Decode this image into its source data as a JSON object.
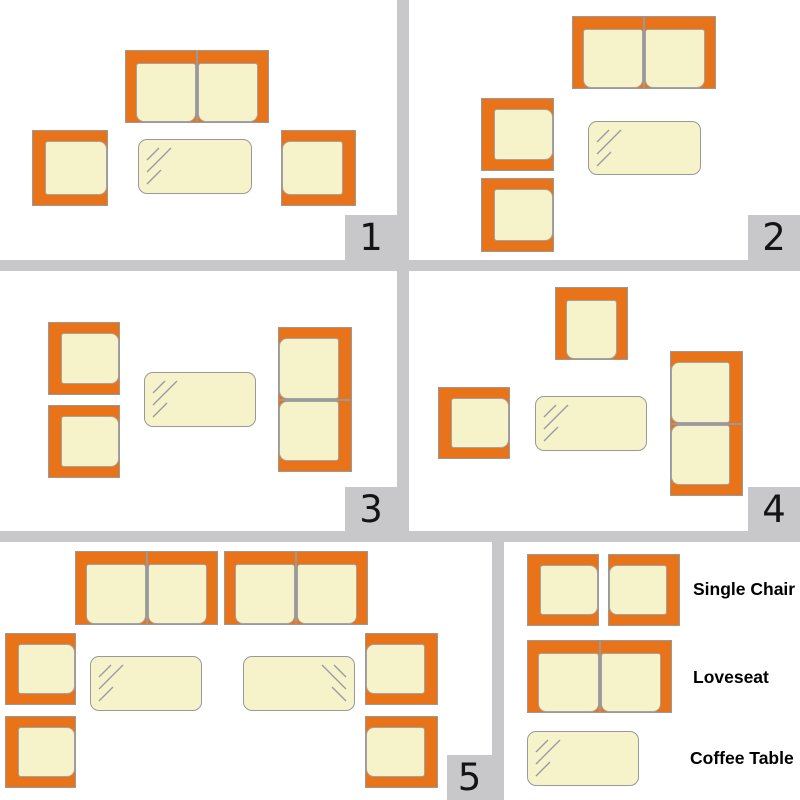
{
  "colors": {
    "frame_orange": "#E87318",
    "cushion_cream": "#F6F3CB",
    "outline_gray": "#999999",
    "divider_gray": "#C8C8CB",
    "number_black": "#141414"
  },
  "panels": [
    {
      "number": "1",
      "pieces": [
        {
          "item": "loveseat",
          "type": "loveseat",
          "x": 125,
          "y": 50,
          "w": 144,
          "h": 73,
          "open": "bottom"
        },
        {
          "item": "single-chair",
          "type": "chair",
          "x": 32,
          "y": 130,
          "w": 76,
          "h": 76,
          "open": "right"
        },
        {
          "item": "coffee-table",
          "type": "table",
          "x": 138,
          "y": 139,
          "w": 114,
          "h": 55,
          "glass": "tl"
        },
        {
          "item": "single-chair",
          "type": "chair",
          "x": 281,
          "y": 130,
          "w": 75,
          "h": 76,
          "open": "left"
        }
      ]
    },
    {
      "number": "2",
      "pieces": [
        {
          "item": "loveseat",
          "type": "loveseat",
          "x": 572,
          "y": 16,
          "w": 144,
          "h": 73,
          "open": "bottom"
        },
        {
          "item": "single-chair",
          "type": "chair",
          "x": 481,
          "y": 98,
          "w": 73,
          "h": 73,
          "open": "right"
        },
        {
          "item": "single-chair",
          "type": "chair",
          "x": 481,
          "y": 178,
          "w": 73,
          "h": 74,
          "open": "right"
        },
        {
          "item": "coffee-table",
          "type": "table",
          "x": 588,
          "y": 121,
          "w": 113,
          "h": 54,
          "glass": "tl"
        }
      ]
    },
    {
      "number": "3",
      "pieces": [
        {
          "item": "single-chair",
          "type": "chair",
          "x": 48,
          "y": 322,
          "w": 72,
          "h": 73,
          "open": "right"
        },
        {
          "item": "single-chair",
          "type": "chair",
          "x": 48,
          "y": 405,
          "w": 72,
          "h": 73,
          "open": "right"
        },
        {
          "item": "coffee-table",
          "type": "table",
          "x": 144,
          "y": 372,
          "w": 112,
          "h": 55,
          "glass": "tl"
        },
        {
          "item": "loveseat",
          "type": "loveseat",
          "x": 278,
          "y": 327,
          "w": 74,
          "h": 145,
          "open": "left"
        }
      ]
    },
    {
      "number": "4",
      "pieces": [
        {
          "item": "single-chair",
          "type": "chair",
          "x": 555,
          "y": 287,
          "w": 73,
          "h": 73,
          "open": "bottom"
        },
        {
          "item": "single-chair",
          "type": "chair",
          "x": 438,
          "y": 387,
          "w": 72,
          "h": 72,
          "open": "right"
        },
        {
          "item": "coffee-table",
          "type": "table",
          "x": 535,
          "y": 396,
          "w": 112,
          "h": 55,
          "glass": "tl"
        },
        {
          "item": "loveseat",
          "type": "loveseat",
          "x": 670,
          "y": 351,
          "w": 73,
          "h": 145,
          "open": "left"
        }
      ]
    },
    {
      "number": "5",
      "pieces": [
        {
          "item": "loveseat",
          "type": "loveseat",
          "x": 75,
          "y": 551,
          "w": 143,
          "h": 74,
          "open": "bottom"
        },
        {
          "item": "loveseat",
          "type": "loveseat",
          "x": 224,
          "y": 551,
          "w": 144,
          "h": 74,
          "open": "bottom"
        },
        {
          "item": "single-chair",
          "type": "chair",
          "x": 5,
          "y": 633,
          "w": 71,
          "h": 72,
          "open": "right"
        },
        {
          "item": "single-chair",
          "type": "chair",
          "x": 5,
          "y": 716,
          "w": 71,
          "h": 72,
          "open": "right"
        },
        {
          "item": "coffee-table",
          "type": "table",
          "x": 90,
          "y": 656,
          "w": 112,
          "h": 55,
          "glass": "tl"
        },
        {
          "item": "coffee-table",
          "type": "table",
          "x": 243,
          "y": 656,
          "w": 112,
          "h": 55,
          "glass": "tr"
        },
        {
          "item": "single-chair",
          "type": "chair",
          "x": 365,
          "y": 633,
          "w": 73,
          "h": 72,
          "open": "left"
        },
        {
          "item": "single-chair",
          "type": "chair",
          "x": 365,
          "y": 716,
          "w": 73,
          "h": 72,
          "open": "left"
        }
      ]
    }
  ],
  "legend": {
    "items": [
      {
        "label": "Single Chair",
        "shapes": [
          {
            "item": "single-chair",
            "type": "chair",
            "x": 527,
            "y": 554,
            "w": 72,
            "h": 72,
            "open": "right"
          },
          {
            "item": "single-chair",
            "type": "chair",
            "x": 608,
            "y": 554,
            "w": 72,
            "h": 72,
            "open": "left"
          }
        ]
      },
      {
        "label": "Loveseat",
        "shapes": [
          {
            "item": "loveseat",
            "type": "loveseat",
            "x": 527,
            "y": 640,
            "w": 145,
            "h": 73,
            "open": "bottom"
          }
        ]
      },
      {
        "label": "Coffee Table",
        "shapes": [
          {
            "item": "coffee-table",
            "type": "table",
            "x": 527,
            "y": 731,
            "w": 112,
            "h": 55,
            "glass": "tl"
          }
        ]
      }
    ]
  }
}
